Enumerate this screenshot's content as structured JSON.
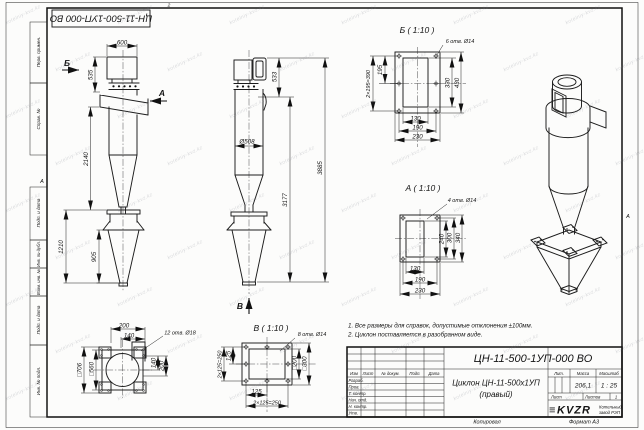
{
  "page": {
    "copied_label": "Копировал",
    "format_label": "Формат А3",
    "zone_letter": "А",
    "zone_number_top": "2"
  },
  "stamp_top": {
    "doc_number": "ЦН-11-500-1УП-000 ВО"
  },
  "frame_labels": {
    "col1": "Перв. примен.",
    "col2": "Справ. №",
    "col3": "Подп. и дата",
    "col4": "Инв. № дубл.",
    "col5": "Взам. инв. №",
    "col6": "Подп. и дата",
    "col7": "Инв. № подл."
  },
  "notes": {
    "line1": "1. Все размеры для справок, допустимые отклонения ±100мм.",
    "line2": "2. Циклон поставляется в разобранном виде."
  },
  "views": {
    "front": {
      "arrow_b": "Б",
      "arrow_a": "А",
      "dim_width": "600",
      "dim_height": "535",
      "dim_cone": "2140",
      "dim_bunker": "1210",
      "dim_hopper": "905"
    },
    "side": {
      "arrow_v": "В",
      "dim_outlet": "533",
      "dim_dia": "Ø508",
      "dim_total": "3885",
      "dim_sub": "3177"
    },
    "detail_b": {
      "title": "Б ( 1:10 )",
      "holes": "6 отв. Ø14",
      "dim_195": "195",
      "dim_390": "2×195=390",
      "dim_330": "330",
      "dim_430": "430",
      "dim_130": "130",
      "dim_190": "190",
      "dim_230": "230"
    },
    "detail_a": {
      "title": "А ( 1:10 )",
      "holes": "4 отв. Ø14",
      "dim_240": "240",
      "dim_300": "300",
      "dim_340": "340",
      "dim_130": "130",
      "dim_190": "190",
      "dim_230": "230"
    },
    "detail_v": {
      "title": "В ( 1:10 )",
      "holes": "8 отв. Ø14",
      "dim_125l": "125",
      "dim_250l": "2×125=250",
      "dim_200": "□200",
      "dim_300": "□300",
      "dim_125b": "125",
      "dim_250b": "2×125=250"
    },
    "plan": {
      "holes": "12 отв. Ø18",
      "dim_200t": "200",
      "dim_140t": "140",
      "dim_706": "□706",
      "dim_560": "□560",
      "dim_140r": "140",
      "dim_200r": "200"
    }
  },
  "title_block": {
    "doc_number": "ЦН-11-500-1УП-000 ВО",
    "name_line1": "Циклон ЦН-11-500х1УП",
    "name_line2": "(правый)",
    "col_izm": "Изм",
    "col_list": "Лист",
    "col_doc": "№ докум.",
    "col_sign": "Подп.",
    "col_date": "Дата",
    "row_razrab": "Разраб.",
    "row_prov": "Пров.",
    "row_tkontr": "Т. контр.",
    "row_nachotd": "Нач. отд.",
    "row_nkontr": "Н. контр.",
    "row_utv": "Утв.",
    "lit_label": "Лит.",
    "mass_label": "Масса",
    "scale_label": "Масштаб",
    "mass_value": "206,1",
    "scale_value": "1 : 25",
    "sheet_label": "Лист",
    "sheets_label": "Листов",
    "sheets_value": "1",
    "logo_bars": "≡",
    "logo": "KVZR",
    "company_line1": "Котельный",
    "company_line2": "завод РЭП"
  },
  "watermark": "kotelniy-kvz.kz"
}
